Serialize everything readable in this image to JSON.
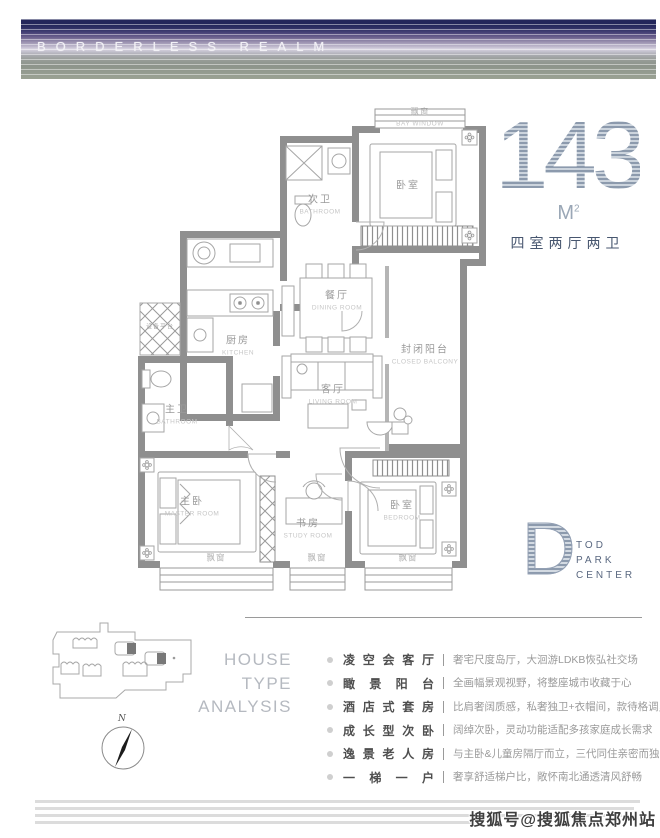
{
  "banner": {
    "title": "BORDERLESS REALM"
  },
  "headline": {
    "number": "143",
    "unit": "M",
    "unit_sup": "2",
    "layout": "四室两厅两卫"
  },
  "floorplan": {
    "rooms": [
      {
        "cn": "飘窗",
        "en": "BAY WINDOW"
      },
      {
        "cn": "次卫",
        "en": "BATHROOM"
      },
      {
        "cn": "卧室",
        "en": ""
      },
      {
        "cn": "厨房",
        "en": "KITCHEN"
      },
      {
        "cn": "餐厅",
        "en": "DINING ROOM"
      },
      {
        "cn": "封闭阳台",
        "en": "CLOSED BALCONY"
      },
      {
        "cn": "设备平台",
        "en": ""
      },
      {
        "cn": "主卫",
        "en": "BATHROOM"
      },
      {
        "cn": "客厅",
        "en": "LIVING ROOM"
      },
      {
        "cn": "主卧",
        "en": "MASTER ROOM"
      },
      {
        "cn": "书房",
        "en": "STUDY ROOM"
      },
      {
        "cn": "卧室",
        "en": "BEDROOM"
      },
      {
        "cn": "飘窗",
        "en": ""
      },
      {
        "cn": "飘窗",
        "en": ""
      },
      {
        "cn": "飘窗",
        "en": ""
      }
    ]
  },
  "dlogo": {
    "letter": "D",
    "line1": "TOD",
    "line2": "PARK",
    "line3": "CENTER"
  },
  "site": {
    "compass_label": "N"
  },
  "analysis": {
    "heading1": "HOUSE",
    "heading2": "TYPE",
    "heading3": "ANALYSIS",
    "items": [
      {
        "title": "凌空会客厅",
        "desc": "奢宅尺度岛厅，大洄游LDKB恢弘社交场"
      },
      {
        "title": "瞰 景 阳 台",
        "desc": "全画幅景观视野，将整座城市收藏于心"
      },
      {
        "title": "酒店式套房",
        "desc": "比肩奢阔质感，私奢独卫+衣帽间，款待格调灵魂"
      },
      {
        "title": "成长型次卧",
        "desc": "阔绰次卧，灵动功能适配多孩家庭成长需求"
      },
      {
        "title": "逸景老人房",
        "desc": "与主卧&儿童房隔厅而立，三代同住亲密而独立"
      },
      {
        "title": "一 梯 一 户",
        "desc": "奢享舒适梯户比，敞怀南北通透清风舒畅"
      }
    ]
  },
  "watermark": "搜狐号@搜狐焦点郑州站",
  "colors": {
    "navy": "#47566f",
    "number_light": "#a9b4c2",
    "wall_gray": "#8f8f8f",
    "banner_top": "#23265a",
    "banner_bottom": "#9aa193"
  }
}
